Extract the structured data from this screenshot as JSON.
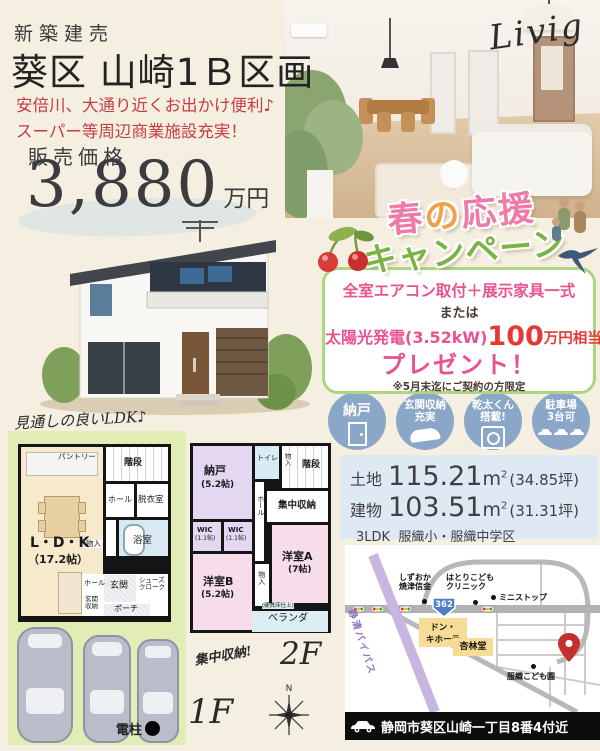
{
  "flyer": {
    "badge": "新築建売",
    "title": "葵区 山崎1Ｂ区画",
    "catch_line1": "安倍川、大通り近くお出かけ便利♪",
    "catch_line2": "スーパー等周辺商業施設充実！",
    "price_label": "販売価格",
    "price_value": "3,880",
    "price_unit": "万円"
  },
  "photo": {
    "caption": "Livig"
  },
  "campaign": {
    "t_haru": "春",
    "t_no": "の",
    "t_ouen": "応援",
    "t_line2": "キャンペーン",
    "offer1": "全室エアコン取付＋展示家具一式",
    "or": "または",
    "offer2_item": "太陽光発電(3.52kW)",
    "offer2_amount": "100",
    "offer2_unit": "万円相当",
    "present": "プレゼント！",
    "note": "※5月末迄にご契約の方限定"
  },
  "features": {
    "f1": {
      "line1": "納戸"
    },
    "f2": {
      "line1": "玄関収納",
      "line2": "充実"
    },
    "f3": {
      "line1": "乾太くん",
      "line2": "搭載!"
    },
    "f4": {
      "line1": "駐車場",
      "line2": "3台可"
    }
  },
  "specs": {
    "land_label": "土地",
    "land_area": "115.21",
    "land_tsubo": "(34.85坪)",
    "bldg_label": "建物",
    "bldg_area": "103.51",
    "bldg_tsubo": "(31.31坪)",
    "unit_m": "m",
    "unit_sup": "2",
    "layout": "3LDK",
    "school": "服織小・服織中学区"
  },
  "map": {
    "bank1": "しずおか",
    "bank2": "焼津信金",
    "clinic1": "はとりこども",
    "clinic2": "クリニック",
    "ministop": "ミニストップ",
    "route": "362",
    "donki1": "ドン・",
    "donki2": "キホーテ",
    "kyorindo": "杏林堂",
    "bypass": "静清バイパス",
    "kodomoen": "服織こども園",
    "address": "静岡市葵区山崎一丁目8番4付近"
  },
  "plan1f": {
    "caption": "見通しの良いLDK♪",
    "ldk": "L・D・K",
    "ldk_size": "（17.2帖）",
    "pantry": "パントリー",
    "stairs": "階段",
    "hall1": "ホール",
    "dressing": "脱衣室",
    "bath": "浴室",
    "closet": "物入",
    "hall2": "ホール",
    "entrance": "玄関",
    "shoes1": "シューズ",
    "shoes2": "クローク",
    "storage1": "玄関",
    "storage2": "収納",
    "porch": "ポーチ",
    "pole": "電柱",
    "label": "1F"
  },
  "plan2f": {
    "nando": "納戸",
    "nando_size": "(5.2帖)",
    "toilet": "トイレ",
    "stairs": "階段",
    "closet_top": "物入",
    "central": "集中収納",
    "hall": "ホール",
    "wic": "WIC",
    "wic_size": "(1.1帖)",
    "roomB": "洋室B",
    "roomB_size": "(5.2帖)",
    "roomA": "洋室A",
    "roomA_size": "(7帖)",
    "closet_mid": "物入",
    "veranda_note": "(硬質床仕上)",
    "veranda": "ベランダ",
    "annotation": "集中収納!",
    "label": "2F"
  },
  "compass": {
    "north": "N"
  },
  "colors": {
    "background": "#f4efe1",
    "accent_red": "#c53d44",
    "campaign_pink": "#e8538f",
    "campaign_red": "#e73934",
    "campaign_green": "#7cb342",
    "feature_circle_blue": "#8aa7c8",
    "specs_bg": "#dfe9f3",
    "plan_area_green": "#e2edb5",
    "map_pin": "#c4302e"
  }
}
